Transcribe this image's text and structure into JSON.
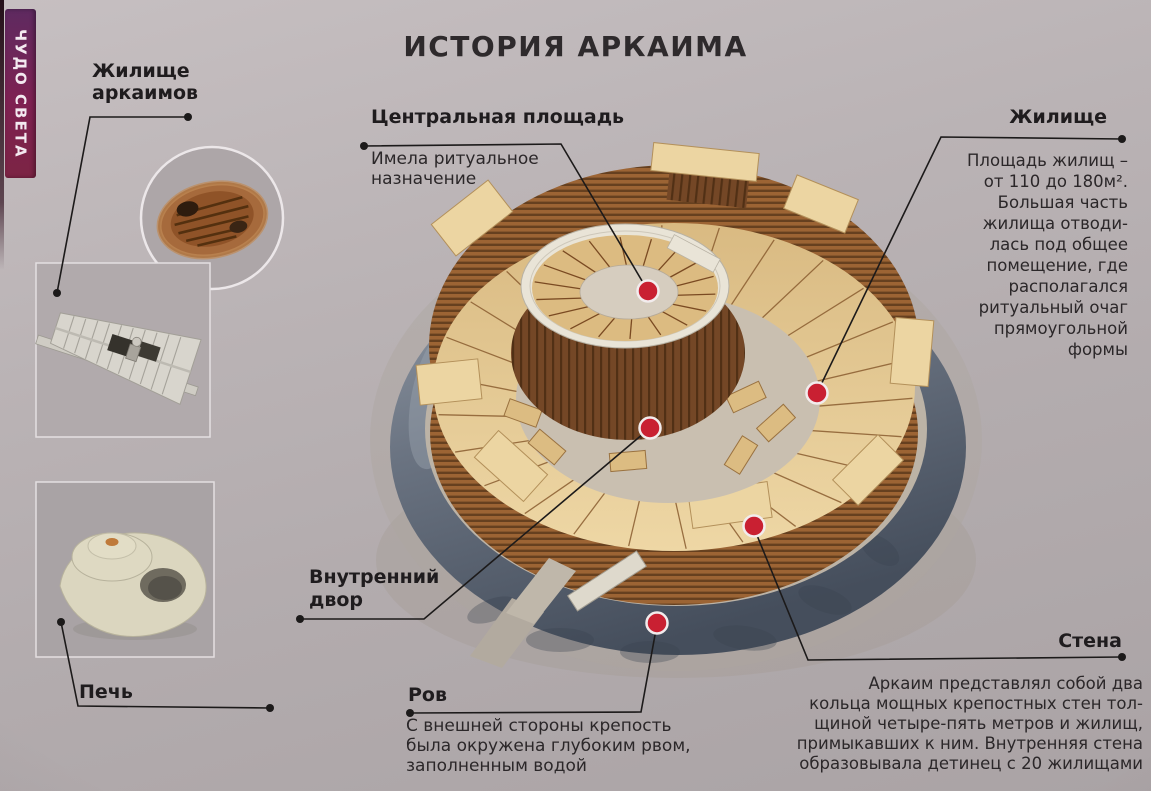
{
  "page": {
    "title": "ИСТОРИЯ АРКАИМА",
    "series_tab": "ЧУДО СВЕТА"
  },
  "callouts": {
    "dwelling_inset_label": "Жилище\nаркаимов",
    "central_square": {
      "title": "Центральная площадь",
      "body": "Имела ритуальное\nназначение"
    },
    "dwelling": {
      "title": "Жилище",
      "body": "Площадь жилищ –\nот 110 до 180м².\nБольшая часть\nжилища отводи-\nлась под общее\nпомещение, где\nрасполагался\nритуальный очаг\nпрямоугольной\nформы"
    },
    "inner_yard_label": "Внутренний\nдвор",
    "moat": {
      "title": "Ров",
      "body": "С внешней стороны крепость\nбыла окружена глубоким рвом,\nзаполненным водой"
    },
    "wall": {
      "title": "Стена",
      "body": "Аркаим представлял собой два\nкольца мощных крепостных стен тол-\nщиной четыре-пять метров и жилищ,\nпримыкавших к ним. Внутренняя стена\nобразовывала детинец с 20 жилищами"
    },
    "oven_label": "Печь"
  },
  "colors": {
    "marker_red": "#c92032",
    "tab_gradient_top": "#5e2a60",
    "tab_gradient_bottom": "#7c2444",
    "page_bg": "#b6afb1"
  }
}
